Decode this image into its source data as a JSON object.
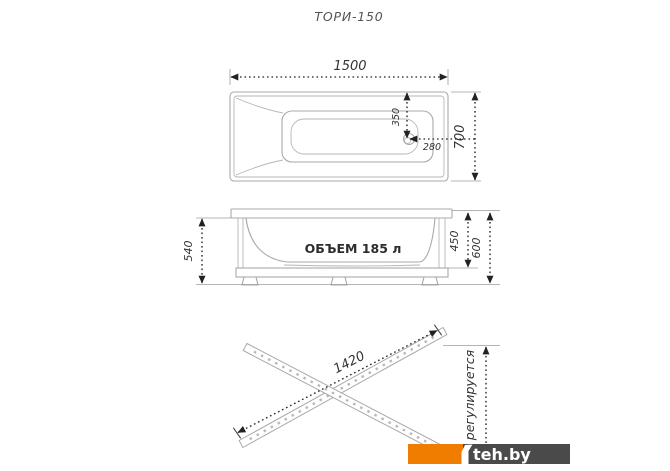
{
  "title": "ТОРИ-150",
  "top_view": {
    "length": "1500",
    "width": "700",
    "drain_offset_center": "350",
    "drain_offset_end": "280"
  },
  "side_view": {
    "volume": "ОБЪЕМ 185 л",
    "height_overall_left": "540",
    "height_shell": "450",
    "height_overall_right": "600"
  },
  "frame_view": {
    "rail_length": "1420",
    "adjustable": "регулируется"
  },
  "watermark": {
    "text": "teh.by",
    "orange": "#F07D00",
    "dark": "#4A4A4A"
  }
}
